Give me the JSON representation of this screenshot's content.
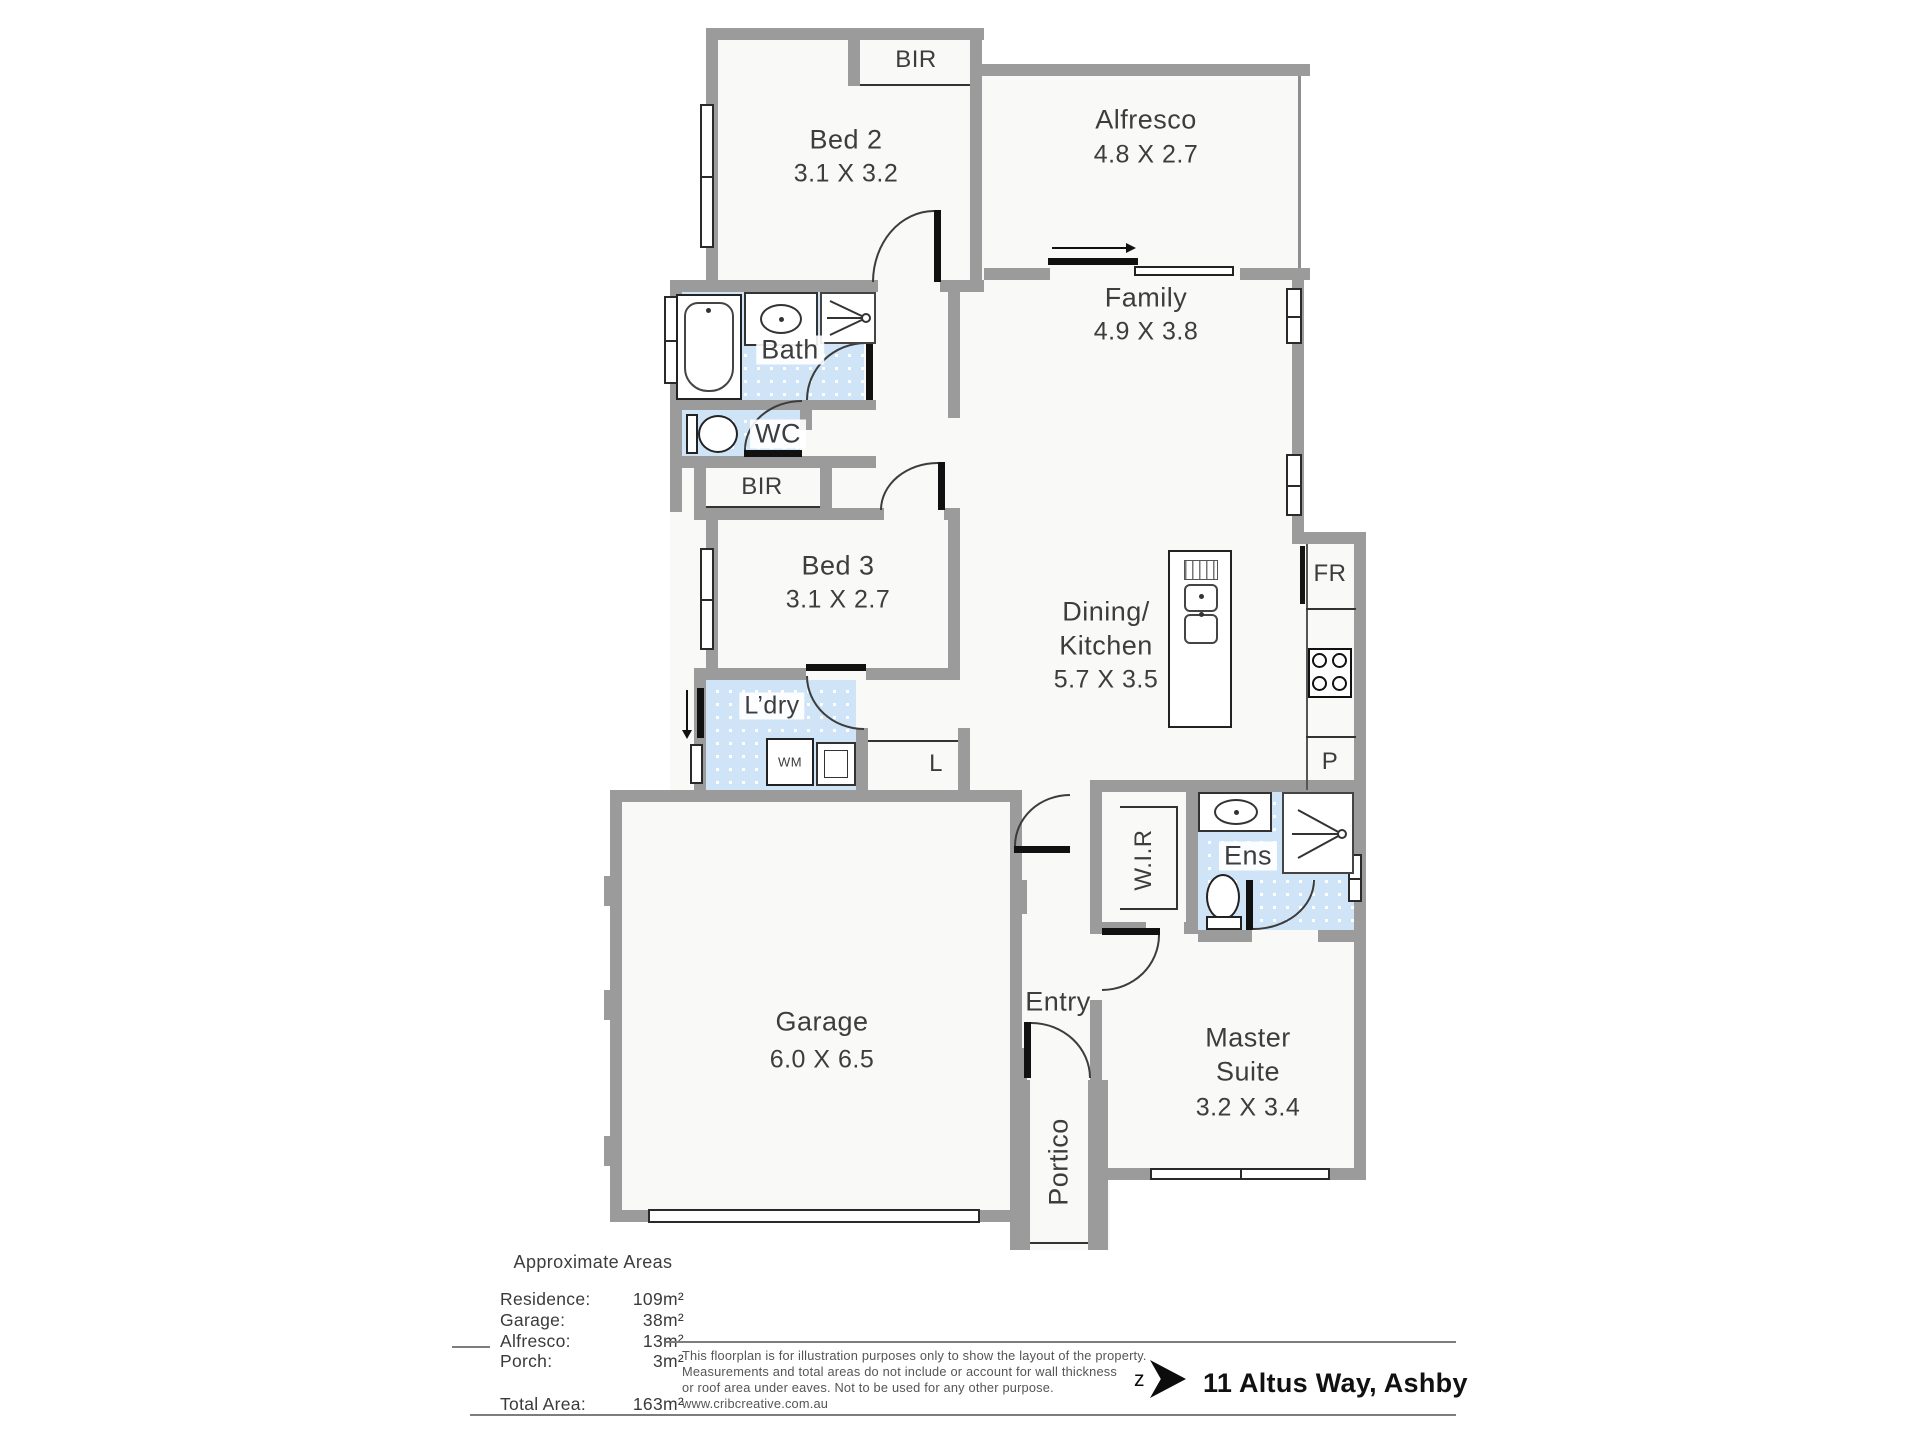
{
  "plan": {
    "rooms": {
      "bed2": {
        "name": "Bed 2",
        "dims": "3.1 X 3.2"
      },
      "bed3": {
        "name": "Bed 3",
        "dims": "3.1 X 2.7"
      },
      "alfresco": {
        "name": "Alfresco",
        "dims": "4.8 X 2.7"
      },
      "family": {
        "name": "Family",
        "dims": "4.9 X 3.8"
      },
      "dining_kitchen": {
        "line1": "Dining/",
        "line2": "Kitchen",
        "dims": "5.7 X 3.5"
      },
      "garage": {
        "name": "Garage",
        "dims": "6.0 X 6.5"
      },
      "master_suite": {
        "line1": "Master",
        "line2": "Suite",
        "dims": "3.2 X 3.4"
      },
      "bath": {
        "name": "Bath"
      },
      "wc": {
        "name": "WC"
      },
      "laundry": {
        "name": "L’dry"
      },
      "ensuite": {
        "name": "Ens"
      },
      "entry": {
        "name": "Entry"
      },
      "portico": {
        "name": "Portico"
      },
      "wir": {
        "name": "W.I.R"
      }
    },
    "fixtures": {
      "bir_bed2": "BIR",
      "bir_bed3": "BIR",
      "linen": "L",
      "fridge_recess": "FR",
      "pantry": "P",
      "washing_machine": "WM"
    }
  },
  "areas": {
    "title": "Approximate Areas",
    "rows": [
      {
        "label": "Residence:",
        "value": "109m²"
      },
      {
        "label": "Garage:",
        "value": "38m²"
      },
      {
        "label": "Alfresco:",
        "value": "13m²"
      },
      {
        "label": "Porch:",
        "value": "3m²"
      }
    ],
    "total": {
      "label": "Total Area:",
      "value": "163m²"
    }
  },
  "footer": {
    "disclaimer_lines": [
      "This floorplan is for illustration purposes only to show the layout of the property.",
      "Measurements and total areas do not include or account for wall thickness",
      "or roof area under eaves. Not to be used for any other purpose.",
      "www.cribcreative.com.au"
    ],
    "logo_letter": "z",
    "address": "11 Altus Way, Ashby"
  },
  "colors": {
    "wall": "#9b9b9b",
    "tile_blue": "#cfe4f6"
  }
}
